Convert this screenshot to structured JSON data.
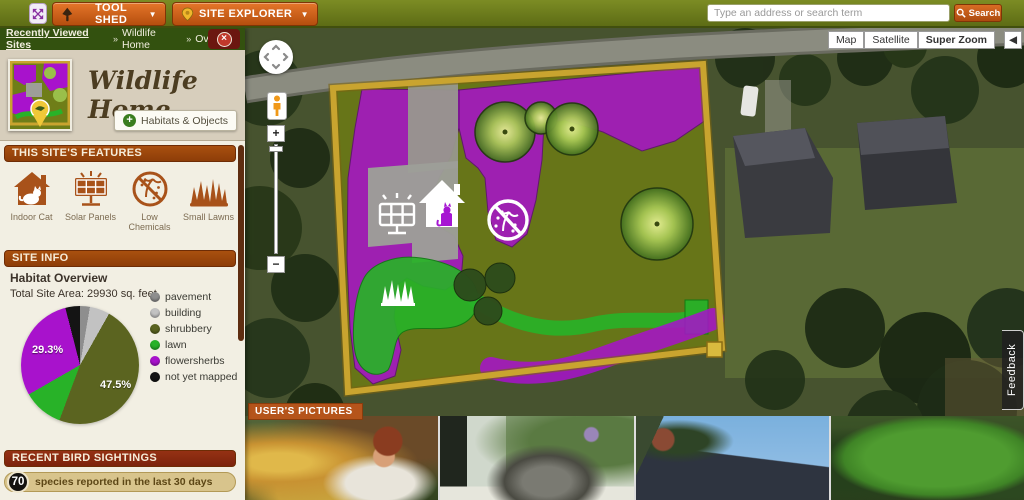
{
  "topbar": {
    "tool_shed_label": "TOOL SHED",
    "site_explorer_label": "SITE EXPLORER",
    "search_placeholder": "Type an address or search term",
    "search_button_label": "Search",
    "chevron": "▼",
    "accent_orange": "#c85a14",
    "bar_green": "#68761c"
  },
  "breadcrumb": {
    "root": "Recently Viewed Sites",
    "separator": "»",
    "site": "Wildlife Home",
    "page": "Overview"
  },
  "site_header": {
    "title": "Wildlife Home",
    "habitats_objects_button": "Habitats & Objects",
    "plus_glyph": "+"
  },
  "features": {
    "header": "THIS SITE'S FEATURES",
    "items": [
      {
        "icon": "indoor-cat-icon",
        "label": "Indoor Cat"
      },
      {
        "icon": "solar-panels-icon",
        "label": "Solar Panels"
      },
      {
        "icon": "low-chemicals-icon",
        "label": "Low Chemicals"
      },
      {
        "icon": "small-lawns-icon",
        "label": "Small Lawns"
      }
    ]
  },
  "site_info": {
    "header": "SITE INFO",
    "subtitle": "Habitat Overview",
    "total_area_label": "Total Site Area: 29930 sq. feet"
  },
  "chart_data": {
    "type": "pie",
    "title": "Habitat Overview",
    "labels": [
      "pavement",
      "building",
      "shrubbery",
      "lawn",
      "flowersherbs",
      "not yet mapped"
    ],
    "values": [
      2.7,
      5.5,
      47.5,
      11.0,
      29.3,
      4.0
    ],
    "colors": [
      "#8e8e8e",
      "#c2c2c2",
      "#5b6420",
      "#28b228",
      "#a812cc",
      "#141414"
    ],
    "annotations": [
      {
        "slice": "flowersherbs",
        "text": "29.3%"
      },
      {
        "slice": "shrubbery",
        "text": "47.5%"
      }
    ],
    "legend_position": "right"
  },
  "bird_sightings": {
    "header": "RECENT BIRD SIGHTINGS",
    "count": "70",
    "summary": "species reported in the last 30 days"
  },
  "map": {
    "type_buttons": {
      "map": "Map",
      "satellite": "Satellite",
      "super_zoom": "Super Zoom",
      "selected": "Super Zoom"
    },
    "collapse_arrow": "◀",
    "zoom_in": "+",
    "zoom_out": "−",
    "pictures_label": "USER'S PICTURES",
    "feedback_label": "Feedback",
    "overlay_colors": {
      "flowersherbs": "#a812cc",
      "shrubbery": "#6e7d14",
      "lawn": "#28b228",
      "building": "#9d9e98",
      "boundary": "#c9a42f"
    },
    "pictures": [
      "child beside ornamental grasses",
      "cat resting on windowsill",
      "roof with solar panels",
      "backyard lawn and garden"
    ]
  }
}
